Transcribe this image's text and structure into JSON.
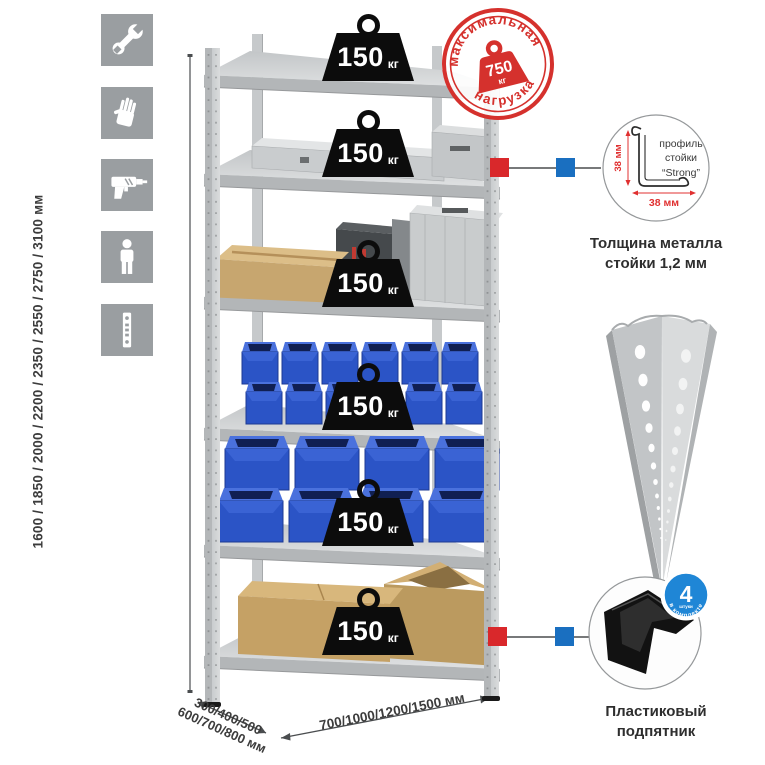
{
  "colors": {
    "accent_red": "#d5312d",
    "marker_red": "#d9282b",
    "marker_blue": "#1a6fc0",
    "bin_blue": "#2b54c6",
    "badge_blue": "#1f86d6",
    "icon_gray": "#9a9ea1"
  },
  "icons_panel": {
    "items": [
      {
        "name": "wrench"
      },
      {
        "name": "gloves"
      },
      {
        "name": "drill"
      },
      {
        "name": "person"
      },
      {
        "name": "perforated-post"
      }
    ]
  },
  "dimensions": {
    "height_label": "1600 / 1850 / 2000 / 2200 / 2350 / 2550 / 2750 / 3100 мм",
    "depth_line1": "300/400/500",
    "depth_line2": "600/700/800 мм",
    "width_label": "700/1000/1200/1500 мм"
  },
  "max_load_stamp": {
    "arc_top": "максимальная",
    "arc_bottom": "нагрузка",
    "weight_value": "750",
    "weight_unit": "кг"
  },
  "shelf_weights": {
    "items": [
      {
        "value": "150",
        "unit": "кг"
      },
      {
        "value": "150",
        "unit": "кг"
      },
      {
        "value": "150",
        "unit": "кг"
      },
      {
        "value": "150",
        "unit": "кг"
      },
      {
        "value": "150",
        "unit": "кг"
      },
      {
        "value": "150",
        "unit": "кг"
      }
    ]
  },
  "profile_detail": {
    "label_line1": "профиль",
    "label_line2": "стойки",
    "label_line3": "“Strong”",
    "dim_height": "38 мм",
    "dim_width": "38 мм",
    "caption": "Толщина металла стойки 1,2 мм"
  },
  "foot_detail": {
    "badge_count": "4",
    "badge_sub": "штуки",
    "badge_arc": "в комплекте",
    "caption": "Пластиковый подпятник"
  }
}
